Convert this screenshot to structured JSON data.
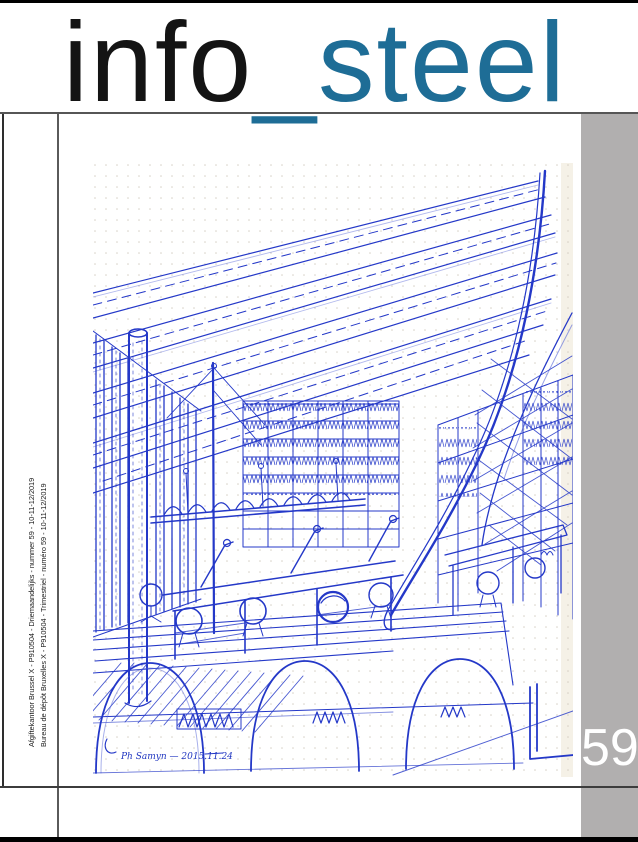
{
  "masthead": {
    "title_word_black": "info",
    "title_word_accent": "_steel",
    "accent_color": "#1e6d96"
  },
  "issue_badge": {
    "number": "59",
    "bar_color": "#b1afaf",
    "text_color": "#ffffff"
  },
  "imprint": {
    "line_dutch": "Afgiftekantoor Brussel X - P910504 - Driemaandelijks - nummer 59 - 10-11-12/2019",
    "line_french": "Bureau de dépôt Bruxelles X - P910504 - Trimestriel - numéro 59 - 10-11-12/2019"
  },
  "sketch": {
    "medium": "blue ballpoint pen on dotted grid paper",
    "subject": "Perspective sketch of a library reading room: slatted ceiling fanning to the right, curved roof beam, slat wall and cylindrical column at left, bookshelves, long reading tables with task lamps and round chairs, hatched deck over three arches",
    "signature": "Ph Samyn — 2015.11.24",
    "ink_color": "#2438c8"
  }
}
